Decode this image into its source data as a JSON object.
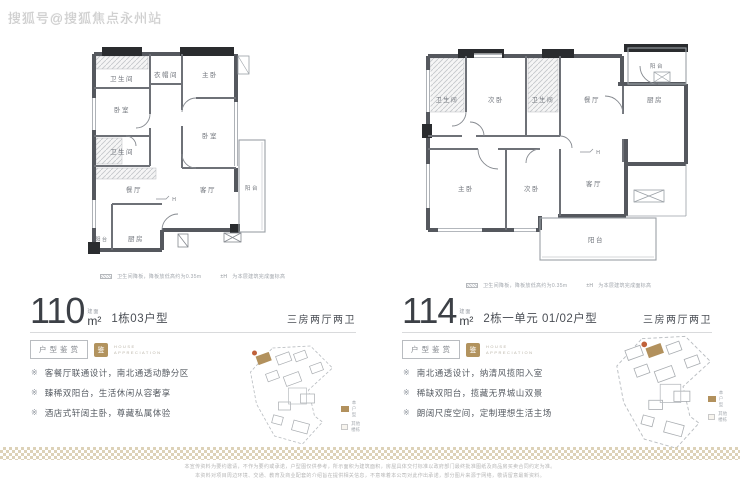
{
  "watermark": "搜狐号@搜狐焦点永州站",
  "legend": {
    "sunken_label": "卫生间降板，降板放低高约为0.35m",
    "level_symbol": "±H",
    "level_label": "为本层建筑完成面标高"
  },
  "badge": {
    "title": "户型鉴赏",
    "seal": "鉴",
    "en_line1": "HOUSE",
    "en_line2": "APPRECIATION"
  },
  "bullet_marker": "※",
  "marker_h": "H",
  "minimap_legend": {
    "self": "本户型",
    "other": "其他楼栋"
  },
  "plans": {
    "left": {
      "area": "110",
      "area_prefix": "建面",
      "area_unit": "m²",
      "subtitle": "1栋03户型",
      "layout_type": "三房两厅两卫",
      "rooms": {
        "bath_top": "卫生间",
        "cloak": "衣帽间",
        "master": "主卧",
        "bed_left": "卧室",
        "bed_right": "卧室",
        "bath_low": "卫生间",
        "dining": "餐厅",
        "living": "客厅",
        "balcony_side": "阳台",
        "kitchen": "厨房",
        "balcony_corner": "阳台"
      },
      "bullets": [
        "客餐厅联通设计，南北通透动静分区",
        "臻稀双阳台，生活休闲从容奢享",
        "酒店式轩阔主卧，尊藏私属体验"
      ]
    },
    "right": {
      "area": "114",
      "area_prefix": "建面",
      "area_unit": "m²",
      "subtitle": "2栋一单元 01/02户型",
      "layout_type": "三房两厅两卫",
      "rooms": {
        "balcony_top": "阳台",
        "bath_left": "卫生间",
        "bed_top": "次卧",
        "bath_mid": "卫生间",
        "dining": "餐厅",
        "kitchen": "厨房",
        "master": "主卧",
        "bed_bottom": "次卧",
        "living": "客厅",
        "balcony_bottom": "阳台"
      },
      "bullets": [
        "南北通透设计，纳清风揽阳入室",
        "稀缺双阳台，揽藏无界城山双景",
        "朗阔尺度空间，定制理想生活主场"
      ]
    }
  },
  "disclaimer": {
    "line1": "本宣传资料为要约邀请，不作为要约或承诺，户型图仅供参考，所示面积为建筑面积，房屋具体交付标准以政府部门最终批准图纸及商品房买卖合同约定为准。",
    "line2": "本资料对项目周边环境、交通、教育及商业配套的介绍旨在提供相关信息，不意味着本公司对此作出承诺，部分图片来源于网络，敬请留意最新资料。"
  }
}
